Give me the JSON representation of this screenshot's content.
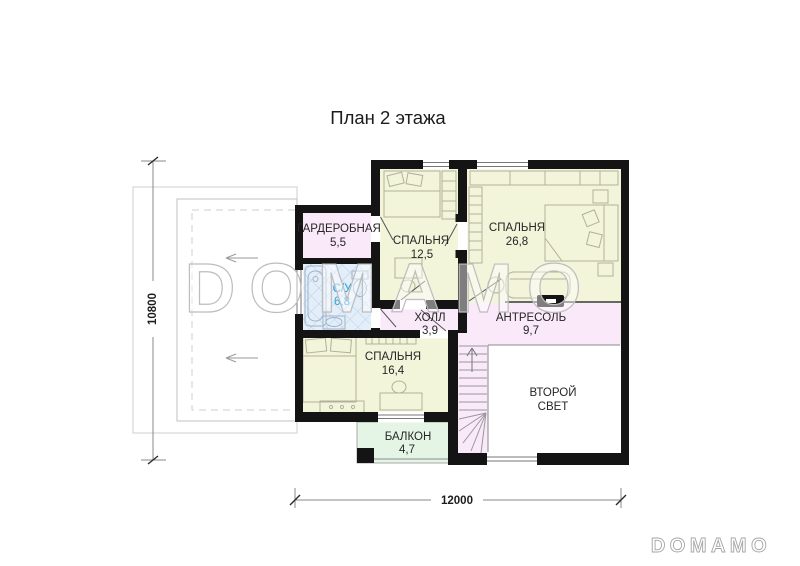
{
  "title": "План 2 этажа",
  "watermark_text": "DOMAMO",
  "logo_text": "DOMAMO",
  "dimensions": {
    "vertical": "10800",
    "horizontal": "12000"
  },
  "rooms": {
    "wardrobe": {
      "label": "ГАРДЕРОБНАЯ",
      "area": "5,5"
    },
    "bedroom_small": {
      "label": "СПАЛЬНЯ",
      "area": "12,5"
    },
    "bedroom_large": {
      "label": "СПАЛЬНЯ",
      "area": "26,8"
    },
    "bathroom": {
      "label": "С/У",
      "area": "6,8"
    },
    "hall": {
      "label": "ХОЛЛ",
      "area": "3,9"
    },
    "mezzanine": {
      "label": "АНТРЕСОЛЬ",
      "area": "9,7"
    },
    "bedroom_mid": {
      "label": "СПАЛЬНЯ",
      "area": "16,4"
    },
    "second_light": {
      "label_line1": "ВТОРОЙ",
      "label_line2": "СВЕТ"
    },
    "balcony": {
      "label": "БАЛКОН",
      "area": "4,7"
    }
  },
  "colors": {
    "wall": "#141414",
    "bedroom_fill": "#f2f5d9",
    "service_fill": "#f9e9f9",
    "bathroom_fill": "#e3eef9",
    "bathroom_hatch": "#b8cfe8",
    "bathroom_text": "#2ea3d9",
    "balcony_fill": "#e4f5e6",
    "watermark": "#bdbdbd"
  }
}
